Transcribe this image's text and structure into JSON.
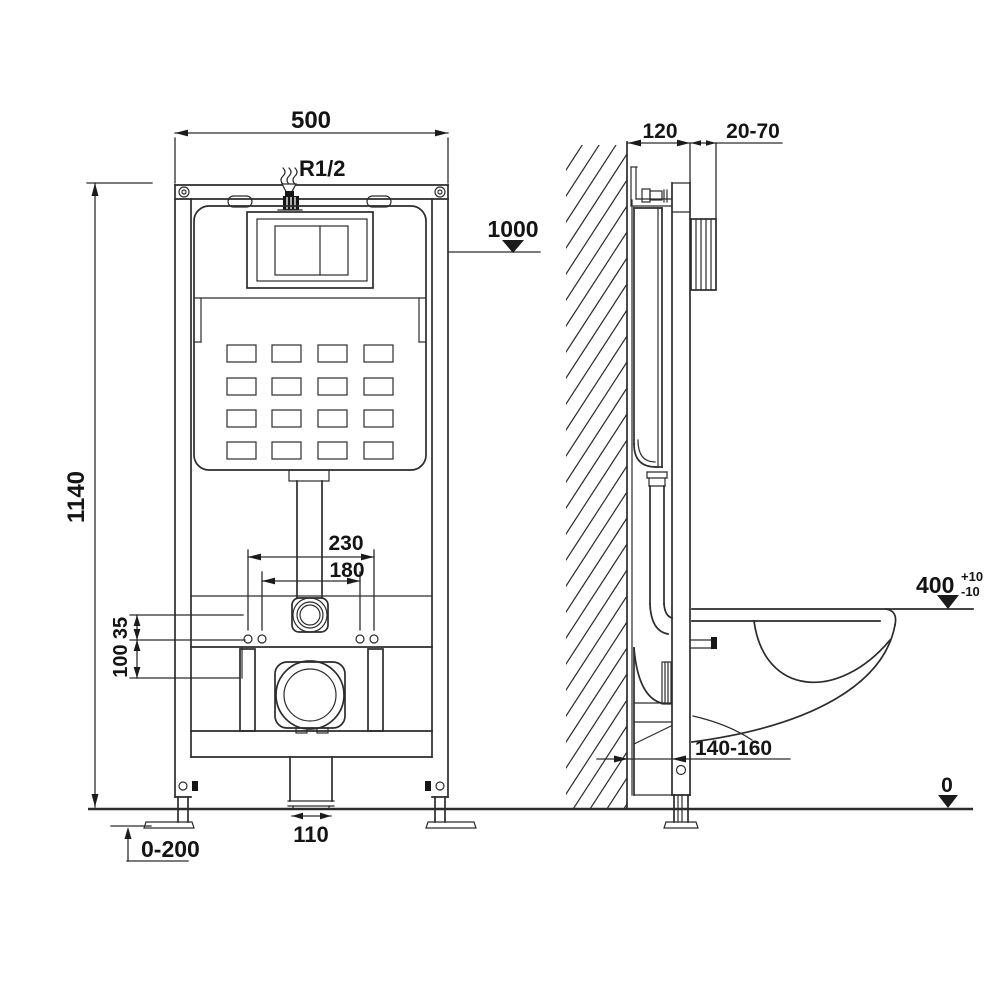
{
  "front_view": {
    "dims": {
      "overall_width": "500",
      "overall_height": "1140",
      "water_inlet": "R1/2",
      "button_panel_height": "1000",
      "fixing_span_outer": "230",
      "fixing_span_inner": "180",
      "offset_upper": "35",
      "offset_lower": "100",
      "drain_pipe_width": "110",
      "leg_adjustment": "0-200"
    }
  },
  "side_view": {
    "dims": {
      "frame_depth": "120",
      "wall_finish_range": "20-70",
      "bowl_height": "400",
      "bowl_height_tol_plus": "+10",
      "bowl_height_tol_minus": "-10",
      "drain_wall_offset": "140-160",
      "floor_level": "0"
    }
  }
}
